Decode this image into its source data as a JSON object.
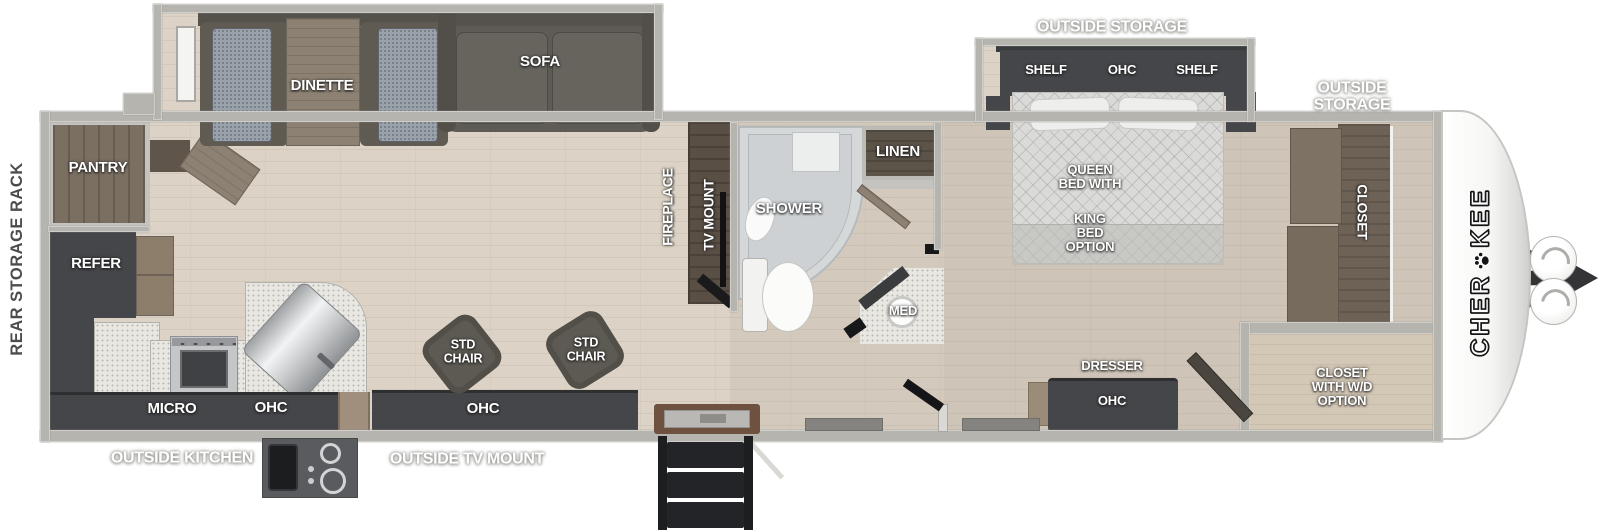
{
  "title": "Cherokee travel trailer floorplan",
  "brand": {
    "name_start": "CHER",
    "name_end": "KEE",
    "full": "CHEROKEE"
  },
  "exterior": {
    "rear_storage_rack": "REAR STORAGE RACK",
    "outside_kitchen": "OUTSIDE KITCHEN",
    "outside_tv_mount": "OUTSIDE TV MOUNT",
    "outside_storage_bedroom": "OUTSIDE STORAGE",
    "outside_storage_front": "OUTSIDE\nSTORAGE"
  },
  "kitchen": {
    "pantry": "PANTRY",
    "refer": "REFER",
    "micro": "MICRO",
    "ohc": "OHC"
  },
  "living": {
    "dinette": "DINETTE",
    "sofa": "SOFA",
    "fireplace": "FIREPLACE",
    "tv_mount": "TV MOUNT",
    "std_chair_left": "STD\nCHAIR",
    "std_chair_right": "STD\nCHAIR",
    "ohc": "OHC"
  },
  "bath": {
    "shower": "SHOWER",
    "linen": "LINEN",
    "med": "MED"
  },
  "bedroom": {
    "shelf_left": "SHELF",
    "ohc_top": "OHC",
    "shelf_right": "SHELF",
    "bed_primary": "QUEEN\nBED WITH",
    "bed_option": "KING\nBED\nOPTION",
    "dresser": "DRESSER",
    "dresser_ohc": "OHC"
  },
  "front": {
    "closet": "CLOSET",
    "closet_wd": "CLOSET\nWITH W/D\nOPTION"
  },
  "colors": {
    "floor": "#dcd3c6",
    "wall": "#b6b4af",
    "cabinet_dark": "#45464a",
    "wood": "#8c8173",
    "walnut": "#5a4f45",
    "cushion": "#99a1ab",
    "bed": "#dadad8",
    "counter": "#e9e7e1",
    "label_text": "#ffffff"
  }
}
